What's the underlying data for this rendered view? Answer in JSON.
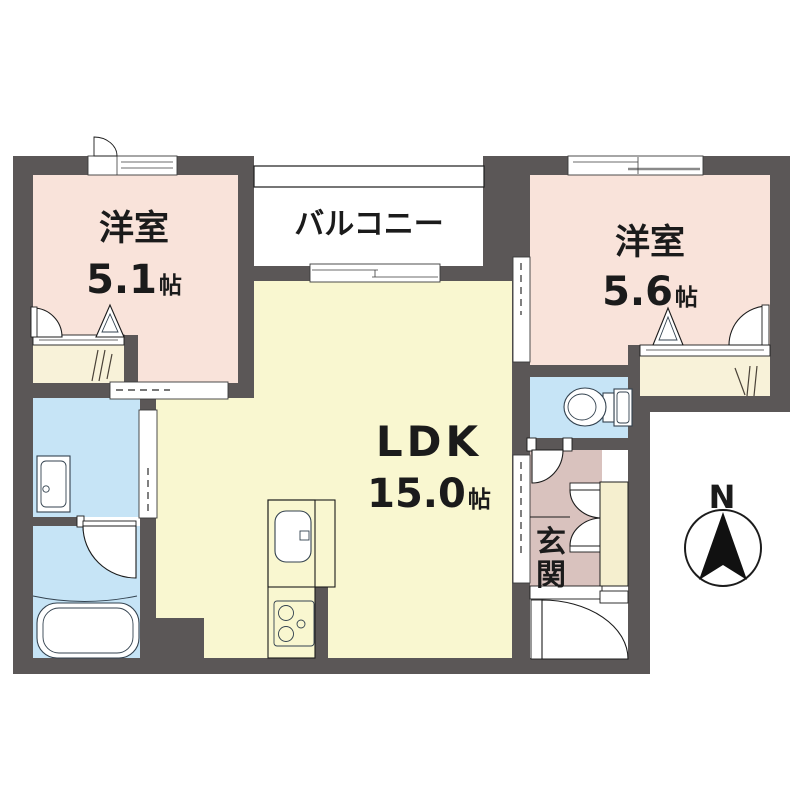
{
  "colors": {
    "page": "#ffffff",
    "wall": "#5b5757",
    "bedroom": "#f9e3da",
    "ldk": "#f9f7d0",
    "water": "#c6e4f6",
    "entrance": "#d9c2be",
    "closet": "#f8f2d9",
    "cabinet": "#f5efcf",
    "fixture": "#33424f"
  },
  "rooms": {
    "bedroom_left": {
      "label": "洋室",
      "size": "5.1",
      "unit": "帖"
    },
    "bedroom_right": {
      "label": "洋室",
      "size": "5.6",
      "unit": "帖"
    },
    "ldk": {
      "label": "LDK",
      "size": "15.0",
      "unit": "帖"
    },
    "balcony": {
      "label": "バルコニー"
    },
    "entrance": {
      "label": "玄関",
      "chars": [
        "玄",
        "関"
      ]
    }
  },
  "compass": {
    "label": "N"
  }
}
